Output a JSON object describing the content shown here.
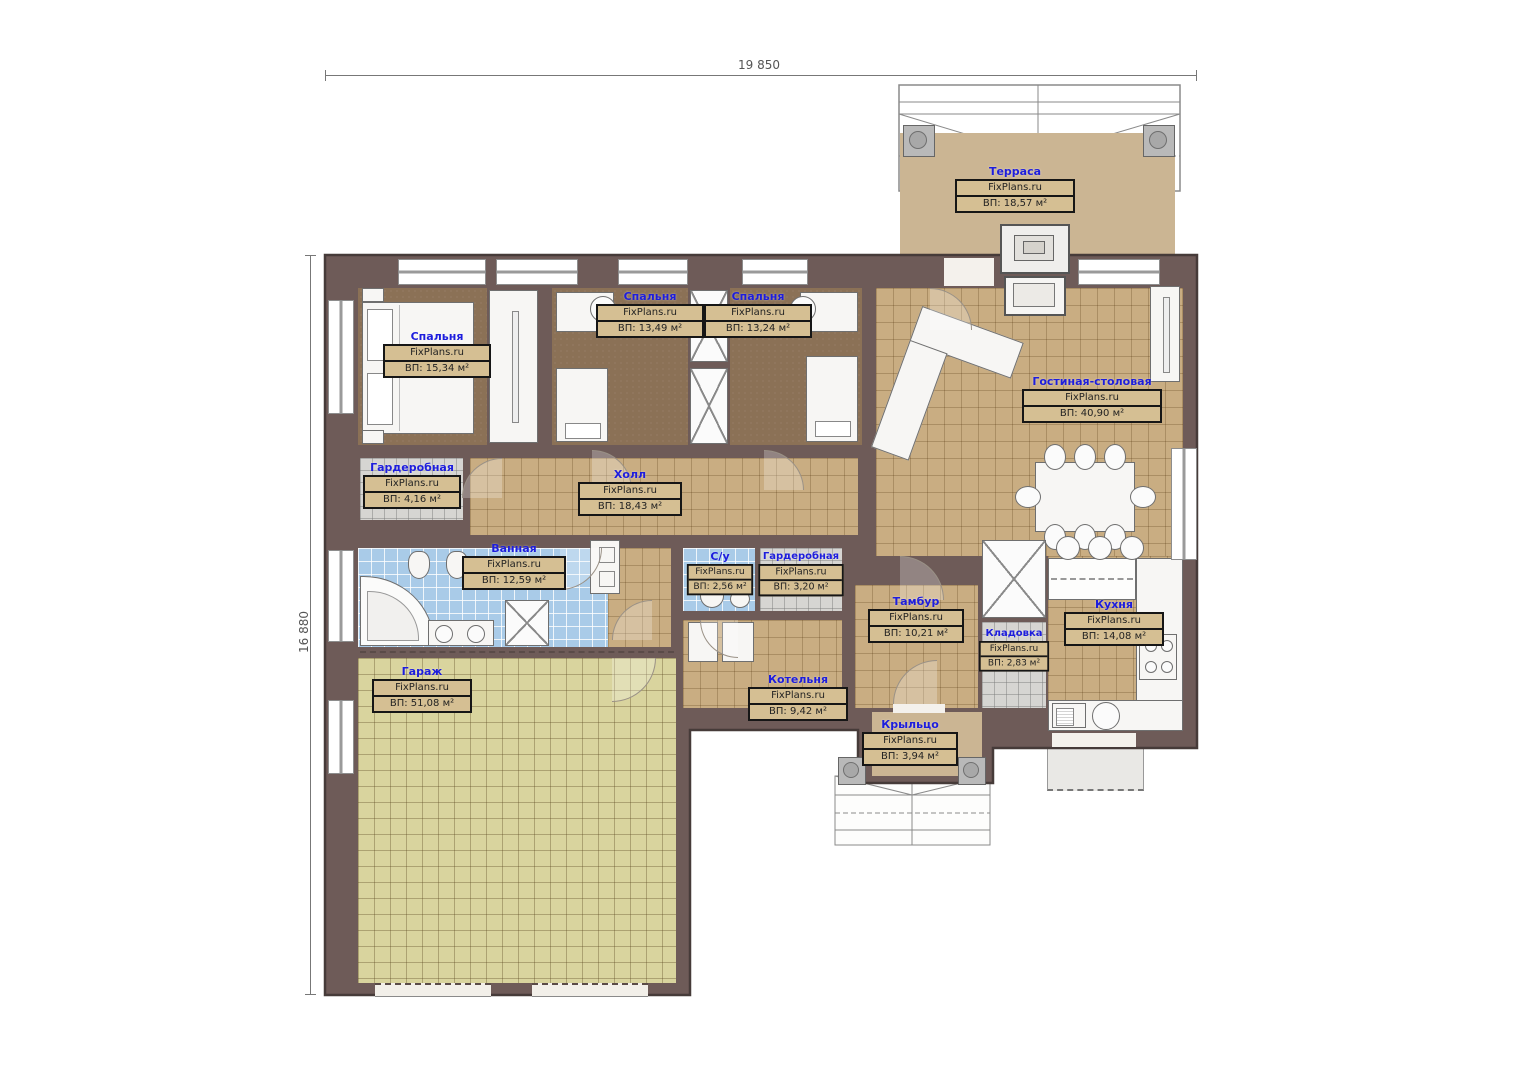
{
  "watermark": "FixPlans.ru",
  "dimensions": {
    "width_label": "19 850",
    "height_label": "16 880"
  },
  "rooms": [
    {
      "id": "terrace",
      "name": "Терраса",
      "area": "ВП: 18,57 м²"
    },
    {
      "id": "bedroom-1",
      "name": "Спальня",
      "area": "ВП: 15,34 м²"
    },
    {
      "id": "bedroom-2",
      "name": "Спальня",
      "area": "ВП: 13,49 м²"
    },
    {
      "id": "bedroom-3",
      "name": "Спальня",
      "area": "ВП: 13,24 м²"
    },
    {
      "id": "living-dining",
      "name": "Гостиная-столовая",
      "area": "ВП: 40,90 м²"
    },
    {
      "id": "wardrobe-1",
      "name": "Гардеробная",
      "area": "ВП: 4,16 м²"
    },
    {
      "id": "hall",
      "name": "Холл",
      "area": "ВП: 18,43 м²"
    },
    {
      "id": "bathroom",
      "name": "Ванная",
      "area": "ВП: 12,59 м²"
    },
    {
      "id": "wc",
      "name": "С/у",
      "area": "ВП: 2,56 м²"
    },
    {
      "id": "wardrobe-2",
      "name": "Гардеробная",
      "area": "ВП: 3,20 м²"
    },
    {
      "id": "vestibule",
      "name": "Тамбур",
      "area": "ВП: 10,21 м²"
    },
    {
      "id": "pantry",
      "name": "Кладовка",
      "area": "ВП: 2,83 м²"
    },
    {
      "id": "kitchen",
      "name": "Кухня",
      "area": "ВП: 14,08 м²"
    },
    {
      "id": "garage",
      "name": "Гараж",
      "area": "ВП: 51,08 м²"
    },
    {
      "id": "boiler",
      "name": "Котельня",
      "area": "ВП: 9,42 м²"
    },
    {
      "id": "porch",
      "name": "Крыльцо",
      "area": "ВП: 3,94 м²"
    }
  ],
  "colors": {
    "wall": "#6e5b58",
    "wall_outline": "#463b39",
    "tile_tan": "#c9ad82",
    "tile_blue": "#a9cbe8",
    "carpet_brown": "#8b7156",
    "garage_floor": "#d9d49e",
    "terrace_floor": "#cbb593",
    "label_blue": "#1d1ddd"
  }
}
